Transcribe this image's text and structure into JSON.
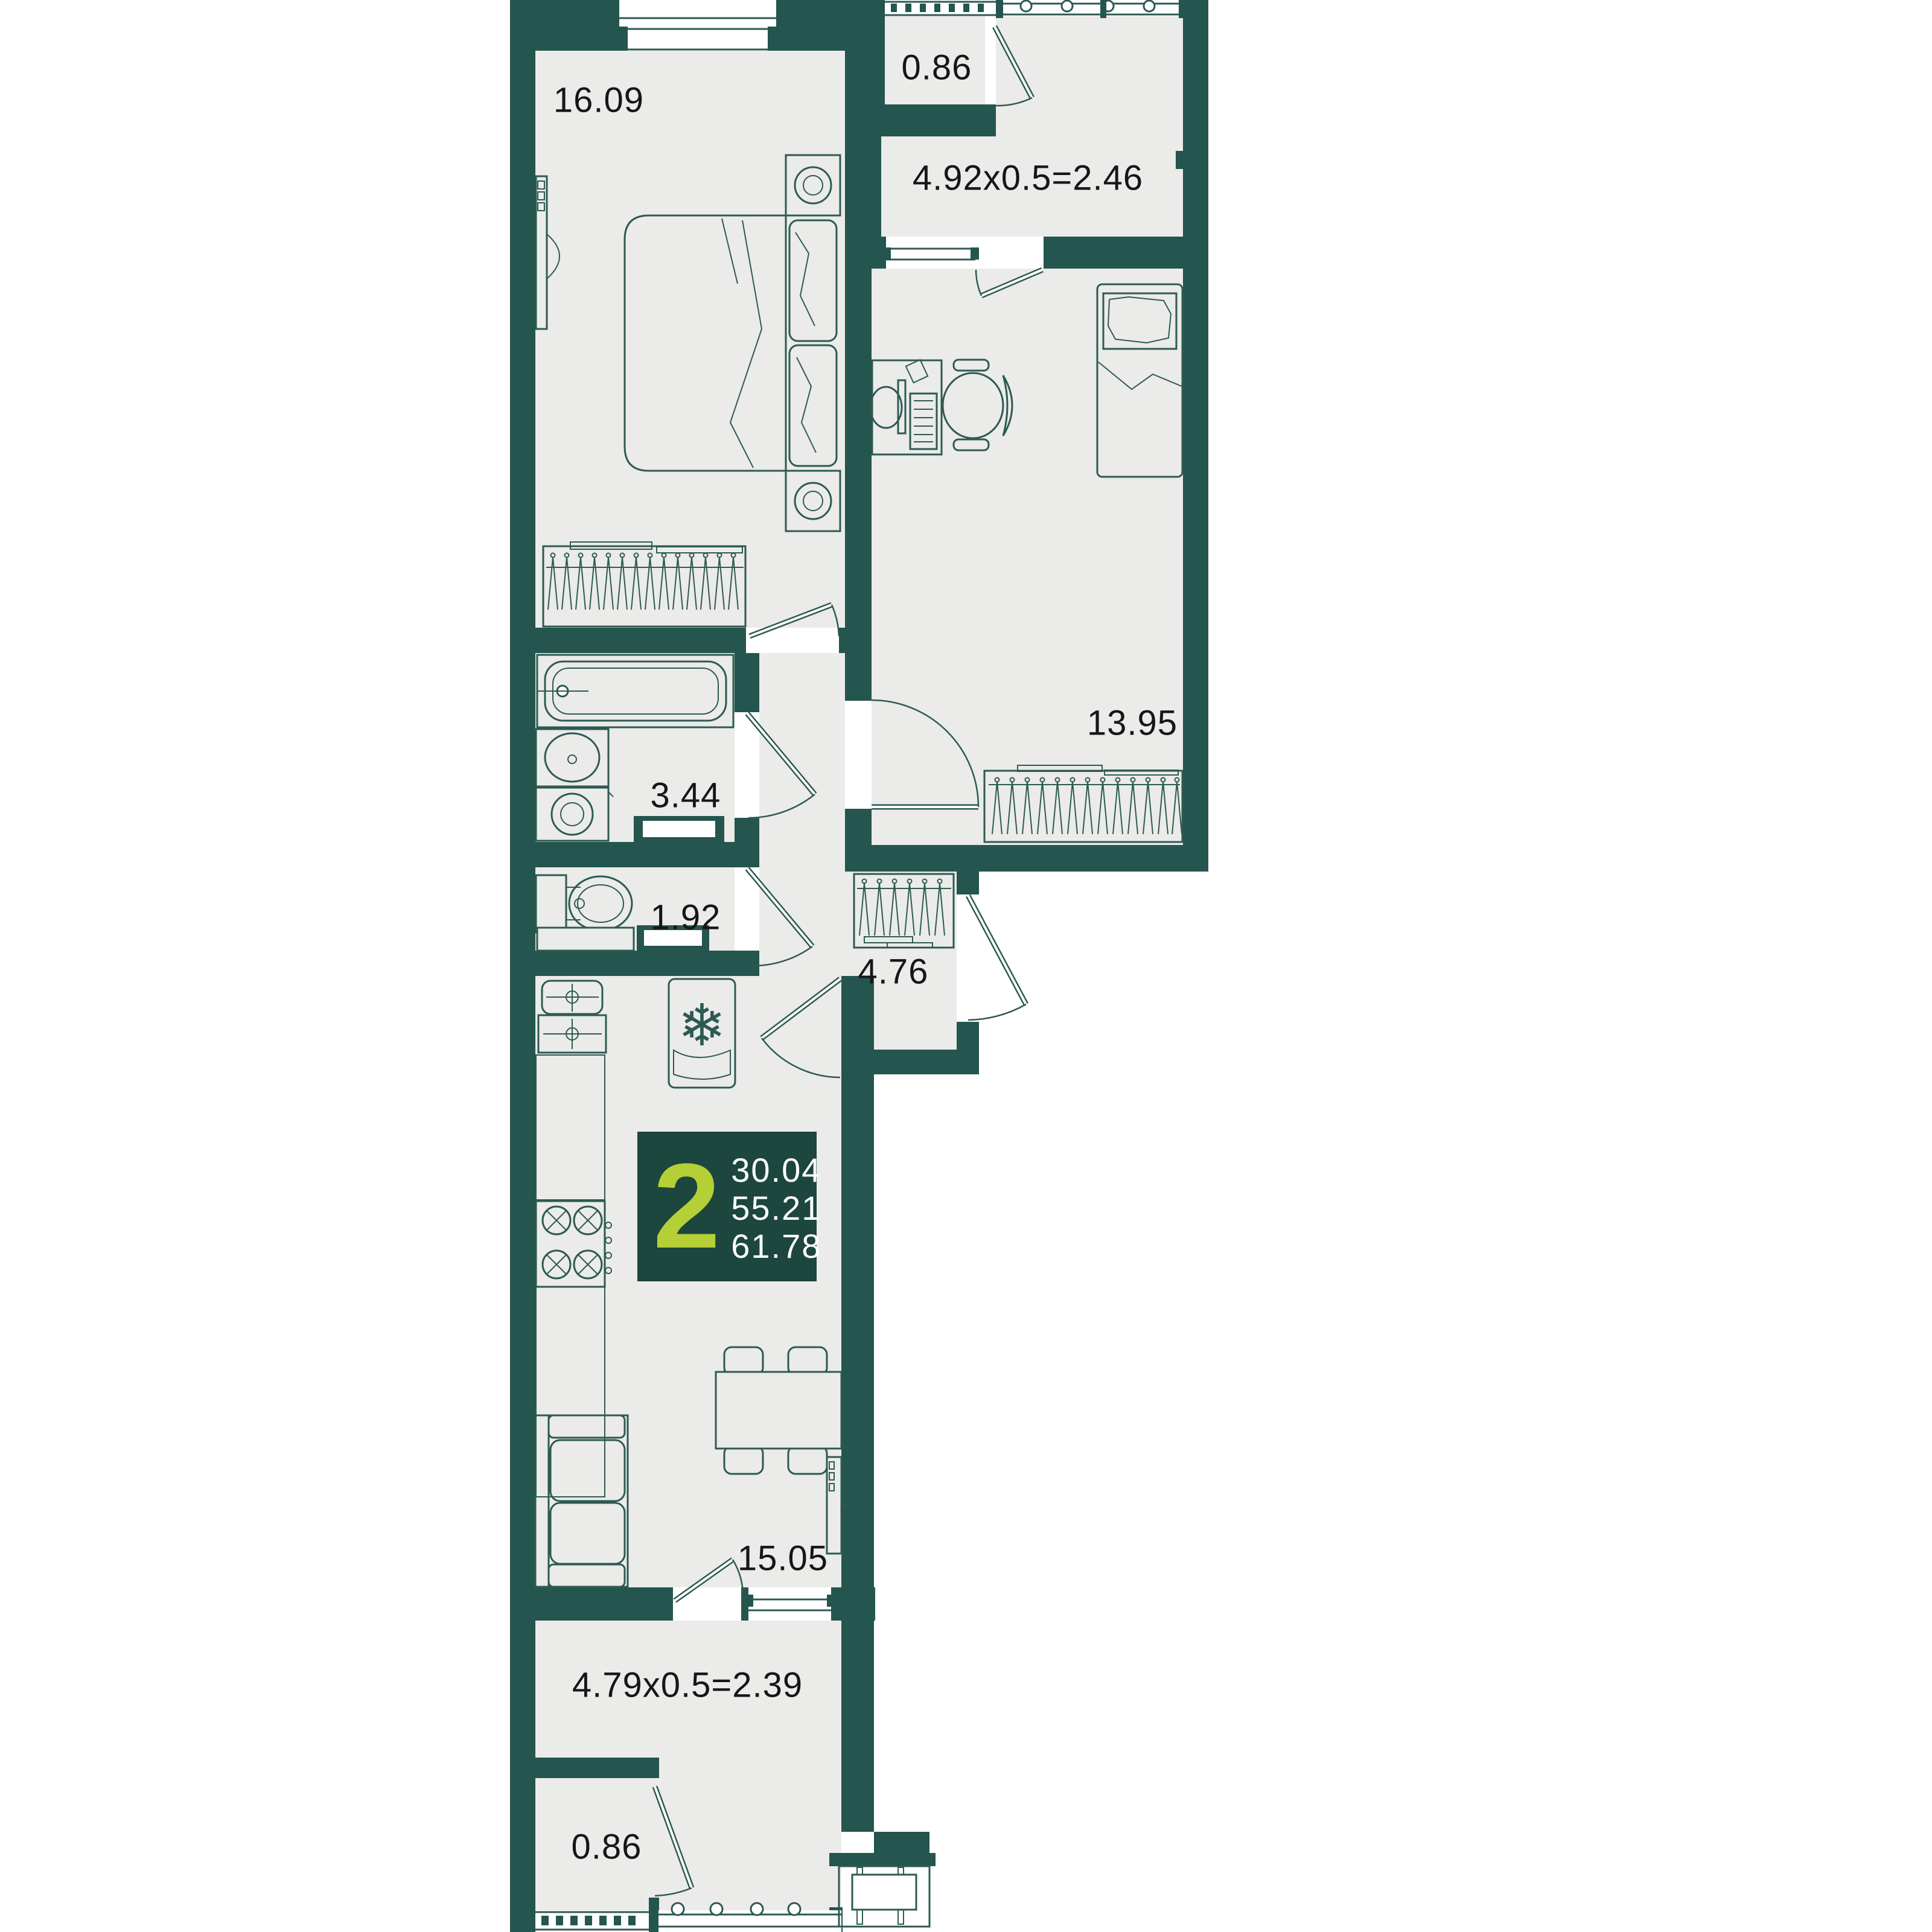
{
  "plan": {
    "title": "2-room apartment floor plan",
    "rooms": {
      "bedroom": {
        "area": "16.09"
      },
      "loggia_top_box": {
        "area": "0.86"
      },
      "loggia_top": {
        "area": "4.92x0.5=2.46"
      },
      "bedroom2": {
        "area": "13.95"
      },
      "bathroom": {
        "area": "3.44"
      },
      "wc": {
        "area": "1.92"
      },
      "hallway": {
        "area": "4.76"
      },
      "kitchen_living": {
        "area": "15.05"
      },
      "loggia_bottom": {
        "area": "4.79x0.5=2.39"
      },
      "loggia_bottom_box": {
        "area": "0.86"
      }
    },
    "info_badge": {
      "rooms_count": "2",
      "areas": [
        "30.04",
        "55.21",
        "61.78"
      ]
    },
    "icons": {
      "snowflake": "❄"
    },
    "colors": {
      "wall": "#24554e",
      "floor": "#ebebe9",
      "line": "#2d5a52",
      "badge_bg": "#1c463e",
      "accent": "#b5cf36",
      "label": "#161616"
    }
  }
}
